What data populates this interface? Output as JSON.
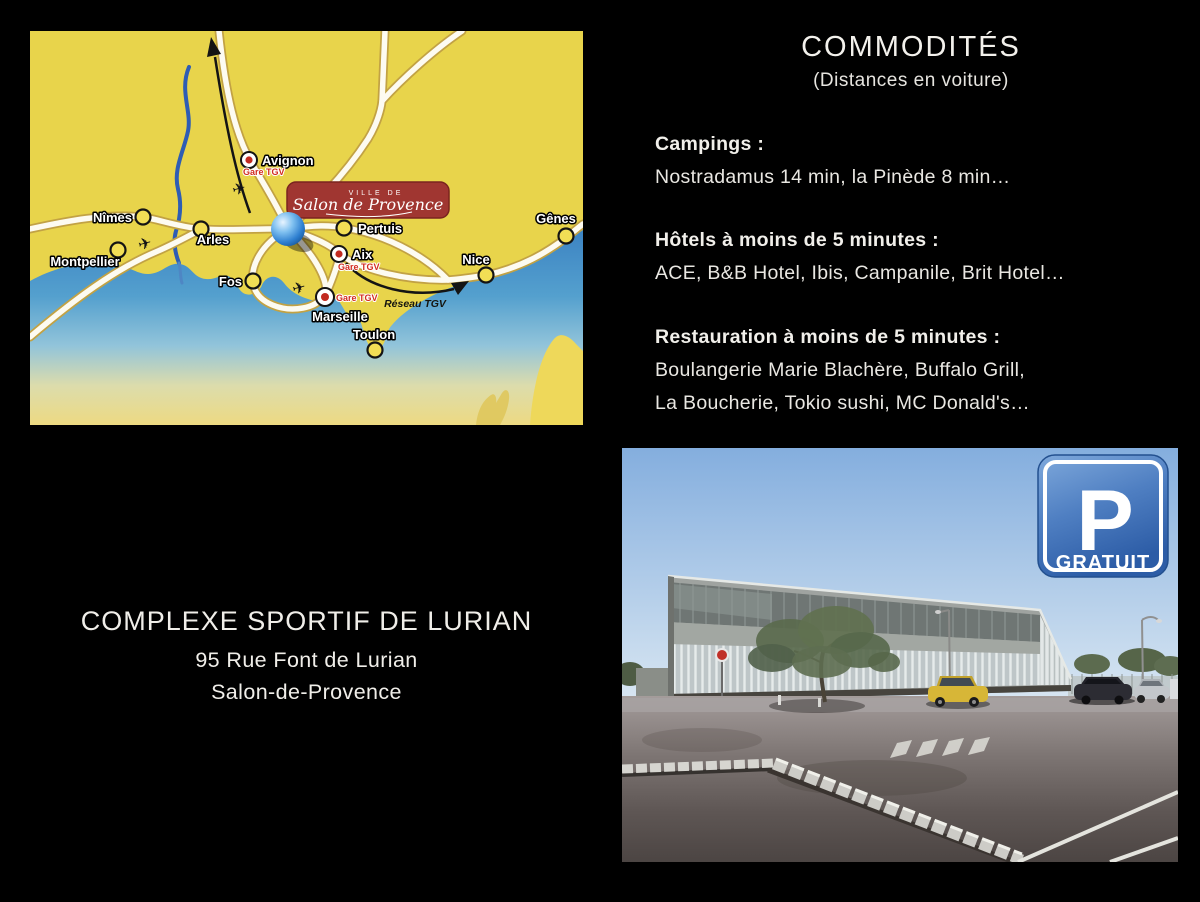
{
  "commodities": {
    "title": "COMMODITÉS",
    "subtitle": "(Distances en voiture)",
    "sections": [
      {
        "header": "Campings :",
        "lines": [
          "Nostradamus 14 min, la Pinède 8 min…"
        ]
      },
      {
        "header": "Hôtels à moins de 5 minutes :",
        "lines": [
          "ACE, B&B Hotel, Ibis, Campanile, Brit Hotel…"
        ]
      },
      {
        "header": "Restauration à moins de 5 minutes :",
        "lines": [
          "Boulangerie Marie Blachère, Buffalo Grill,",
          "La Boucherie, Tokio sushi, MC Donald's…"
        ]
      }
    ]
  },
  "venue": {
    "name": "COMPLEXE SPORTIF DE LURIAN",
    "address_line1": "95 Rue Font de Lurian",
    "address_line2": "Salon-de-Provence"
  },
  "map": {
    "badge_prefix": "VILLE DE",
    "badge_name": "Salon de Provence",
    "gare_tgv_label": "Gare TGV",
    "network_label": "Réseau TGV",
    "cities": {
      "avignon": "Avignon",
      "nimes": "Nîmes",
      "arles": "Arles",
      "montpellier": "Montpellier",
      "fos": "Fos",
      "pertuis": "Pertuis",
      "aix": "Aix",
      "marseille": "Marseille",
      "toulon": "Toulon",
      "nice": "Nice",
      "genes": "Gênes"
    },
    "colors": {
      "land": "#E8D44B",
      "sea": "#4D9FD2",
      "badge_red": "#A03631",
      "road_outline": "#C2A244"
    }
  },
  "parking_sign": {
    "letter": "P",
    "caption": "GRATUIT"
  }
}
